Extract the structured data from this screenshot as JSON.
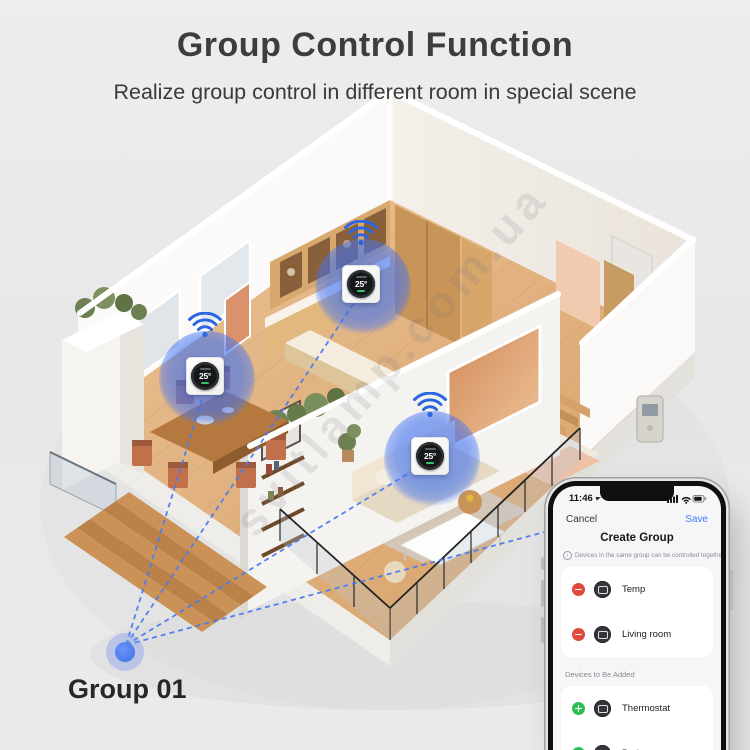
{
  "header": {
    "title": "Group Control Function",
    "subtitle": "Realize group control in different room in special scene"
  },
  "scene": {
    "group_label": "Group 01",
    "watermark": "svitlamp.com.ua",
    "thermostats": [
      {
        "name": "dining-room-thermostat",
        "temp": "25°"
      },
      {
        "name": "kitchen-thermostat",
        "temp": "25°"
      },
      {
        "name": "living-room-thermostat",
        "temp": "25°"
      }
    ]
  },
  "phone": {
    "status_time": "11:46",
    "nav": {
      "cancel": "Cancel",
      "save": "Save",
      "title": "Create Group"
    },
    "note": "Devices in the same group can be controlled together.",
    "group_devices": [
      {
        "name": "Temp"
      },
      {
        "name": "Living room"
      }
    ],
    "add_section_label": "Devices to Be Added",
    "devices_to_add": [
      {
        "name": "Thermostat"
      },
      {
        "name": "Bed room"
      }
    ]
  },
  "colors": {
    "accent_blue": "#3F6FE8",
    "save_blue": "#3E7BF7",
    "remove_red": "#E2493D",
    "add_green": "#2EBD55",
    "device_icon_bg": "#34363C"
  }
}
